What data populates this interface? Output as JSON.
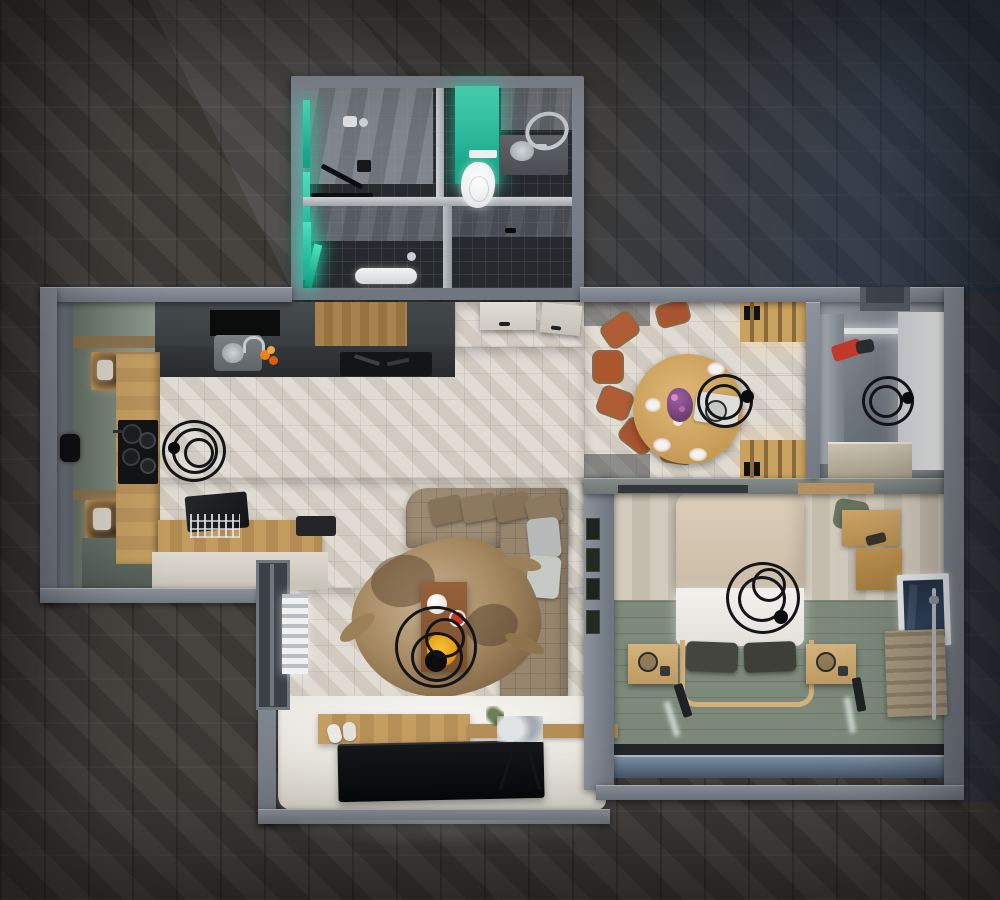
{
  "scene": {
    "title": "Top-down 3D render of a one-bedroom apartment floor plan at night",
    "view": "bird's-eye top-down 3D visualization",
    "background": "dark herringbone parquet surround with a diagonal light beam from the upper left and a cool blue cast on the right",
    "lighting": "dim ambient with warm cabinet LED strips, teal bathroom accent light and a bright white-washed TV wall"
  },
  "palette": {
    "backdrop_parquet": "#403d39",
    "outer_wall_gray": "#848a93",
    "interior_floor_light": "#d7d2c8",
    "accent_teal": "#18c2a0",
    "cabinet_sage": "#83907f",
    "wood_oak": "#c9a263",
    "sofa_taupe": "#9a8a74",
    "chair_terracotta": "#b05c35",
    "bed_duvet_beige": "#d8c9b5",
    "bed_pillow_charcoal": "#45453f",
    "bedroom_floor_sage": "#7e8b7c",
    "tv_black": "#0b0c0d",
    "glow_warm": "#ffd9a0",
    "window_glass_blue": "#2c3a4d",
    "coat_red": "#c23a2c"
  },
  "rooms": {
    "bathroom": {
      "label": "Bathroom and WC with teal LED column, wall-hung toilet, basin, towel ring, shower tray and partition walls"
    },
    "kitchen": {
      "label": "Kitchen with sage cabinet run, lit shelves, oak worktop, black cooktop with pots, sink with fruit, oak island with laptop and dish rack, ring chandelier"
    },
    "hallway": {
      "label": "Hallway with two white doors on light herringbone parquet"
    },
    "dining": {
      "label": "Dining area with round oak table, set plates, purple flowers, terracotta chairs, ring pendant and sage wardrobe with lit oak shelves"
    },
    "entry": {
      "label": "Entry dressing room with bright white wardrobe, red coat, ring pendant and beige cabinet"
    },
    "living": {
      "label": "Living room with taupe corner sofa, cow-hide rug, walnut coffee table with tea set and flowers, ring chandelier, oak media console, TV on glowing wall, sneakers, clothes rack, window with radiator, gallery frames"
    },
    "bedroom": {
      "label": "Bedroom with beige duvet bed, charcoal pillows, oak bench frame, two nightstands with lamps, ring pendant, oak wardrobe shelves, sage plank floor, window with radiator and recessed floor lights"
    }
  }
}
